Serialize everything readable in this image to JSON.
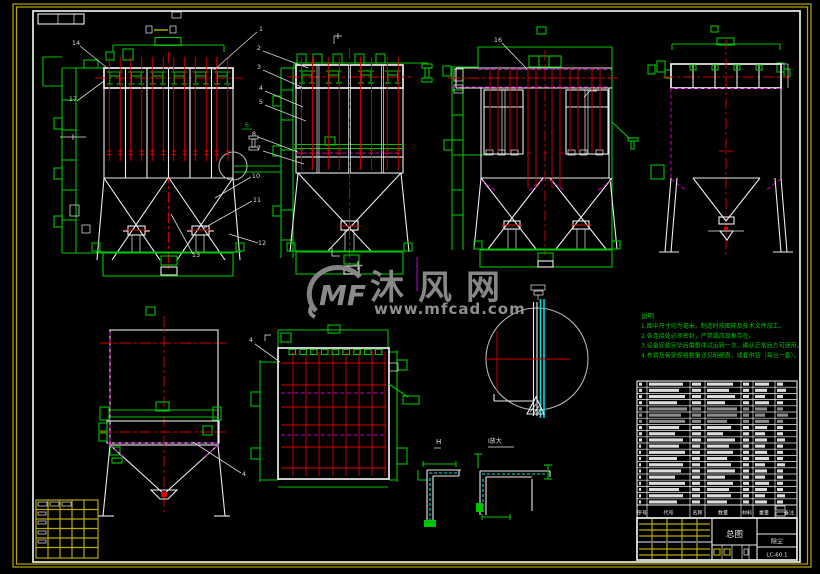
{
  "sheet": {
    "background": "#000000",
    "border_color": "#b8a800",
    "frame_color": "#ededed"
  },
  "colors": {
    "green": "#00c400",
    "red": "#d80000",
    "magenta": "#c800c8",
    "cyan": "#00dcdc",
    "yellow": "#b8a800",
    "white": "#ededed",
    "watermark_gray": "#8a8a8a"
  },
  "watermark": {
    "logo": "MF",
    "name": "沐风网",
    "url": "www.mfcad.com"
  },
  "notes": {
    "title": "说明",
    "lines": [
      "1.图中尺寸均为毫米，制造时按图样及技术文件加工。",
      "2.各连接处必须密封，严禁漏风现象存在。",
      "3.设备安装完毕后需整体试运转一次，确认正常后方可使用。",
      "4.布袋及骨架规格数量详见明细表，成套供货（每台一套）。"
    ]
  },
  "callouts": [
    {
      "n": "1",
      "tx": 261,
      "ty": 31,
      "x1": 257,
      "y1": 32,
      "x2": 214,
      "y2": 70
    },
    {
      "n": "2",
      "tx": 259,
      "ty": 50,
      "x1": 263,
      "y1": 51,
      "x2": 308,
      "y2": 68
    },
    {
      "n": "3",
      "tx": 259,
      "ty": 69,
      "x1": 263,
      "y1": 70,
      "x2": 306,
      "y2": 89
    },
    {
      "n": "4",
      "tx": 261,
      "ty": 90,
      "x1": 265,
      "y1": 91,
      "x2": 303,
      "y2": 107
    },
    {
      "n": "5",
      "tx": 261,
      "ty": 104,
      "x1": 265,
      "y1": 105,
      "x2": 306,
      "y2": 121
    },
    {
      "n": "6",
      "tx": 247,
      "ty": 127,
      "color": "green",
      "underline": true
    },
    {
      "n": "8",
      "tx": 254,
      "ty": 136,
      "x1": 258,
      "y1": 137,
      "x2": 298,
      "y2": 152
    },
    {
      "n": "7",
      "tx": 259,
      "ty": 150,
      "x1": 263,
      "y1": 151,
      "x2": 304,
      "y2": 164
    },
    {
      "n": "10",
      "tx": 256,
      "ty": 178,
      "x1": 251,
      "y1": 177,
      "x2": 215,
      "y2": 198
    },
    {
      "n": "11",
      "tx": 257,
      "ty": 202,
      "x1": 252,
      "y1": 201,
      "x2": 204,
      "y2": 228
    },
    {
      "n": "12",
      "tx": 262,
      "ty": 245,
      "x1": 258,
      "y1": 243,
      "x2": 229,
      "y2": 234
    },
    {
      "n": "13",
      "tx": 196,
      "ty": 257,
      "x1": 193,
      "y1": 254,
      "x2": 171,
      "y2": 214
    },
    {
      "n": "14",
      "tx": 76,
      "ty": 45,
      "x1": 80,
      "y1": 46,
      "x2": 106,
      "y2": 67
    },
    {
      "n": "17",
      "tx": 73,
      "ty": 101,
      "x1": 77,
      "y1": 101,
      "x2": 104,
      "y2": 81
    },
    {
      "n": "16",
      "tx": 498,
      "ty": 42,
      "x1": 502,
      "y1": 43,
      "x2": 527,
      "y2": 69
    },
    {
      "n": "4",
      "tx": 251,
      "ty": 342,
      "x1": 255,
      "y1": 344,
      "x2": 280,
      "y2": 362
    },
    {
      "n": "4",
      "tx": 244,
      "ty": 476,
      "x1": 241,
      "y1": 473,
      "x2": 193,
      "y2": 442
    }
  ],
  "details": {
    "left_label": "H",
    "right_label": "Ⅰ放大"
  },
  "bom": {
    "headers": [
      "序号",
      "代号",
      "名称",
      "数量",
      "材料",
      "重量",
      "备注"
    ],
    "gray_rows": [
      4,
      5,
      6
    ],
    "rows": [
      [
        3,
        34,
        9,
        26,
        6,
        14,
        6
      ],
      [
        3,
        30,
        9,
        22,
        6,
        12,
        9
      ],
      [
        3,
        36,
        9,
        28,
        6,
        10,
        6
      ],
      [
        3,
        28,
        9,
        18,
        6,
        14,
        6
      ],
      [
        3,
        38,
        9,
        30,
        6,
        12,
        6
      ],
      [
        3,
        32,
        9,
        30,
        6,
        10,
        11
      ],
      [
        3,
        36,
        9,
        20,
        6,
        14,
        6
      ],
      [
        3,
        30,
        9,
        24,
        6,
        12,
        6
      ],
      [
        3,
        26,
        9,
        16,
        6,
        10,
        6
      ],
      [
        3,
        34,
        9,
        28,
        6,
        12,
        8
      ],
      [
        2,
        30,
        8,
        22,
        6,
        10,
        6
      ],
      [
        2,
        36,
        8,
        26,
        6,
        12,
        6
      ],
      [
        2,
        28,
        8,
        20,
        6,
        14,
        6
      ],
      [
        2,
        34,
        8,
        24,
        6,
        10,
        8
      ],
      [
        2,
        32,
        8,
        28,
        6,
        12,
        6
      ],
      [
        2,
        26,
        8,
        18,
        6,
        10,
        6
      ],
      [
        2,
        36,
        8,
        26,
        6,
        14,
        6
      ],
      [
        2,
        30,
        8,
        22,
        6,
        12,
        6
      ],
      [
        2,
        34,
        8,
        24,
        6,
        10,
        8
      ],
      [
        2,
        28,
        8,
        20,
        6,
        12,
        6
      ]
    ]
  },
  "title_block": {
    "title": "总图",
    "product": "除尘",
    "drawing_no": "LC-60.1"
  }
}
